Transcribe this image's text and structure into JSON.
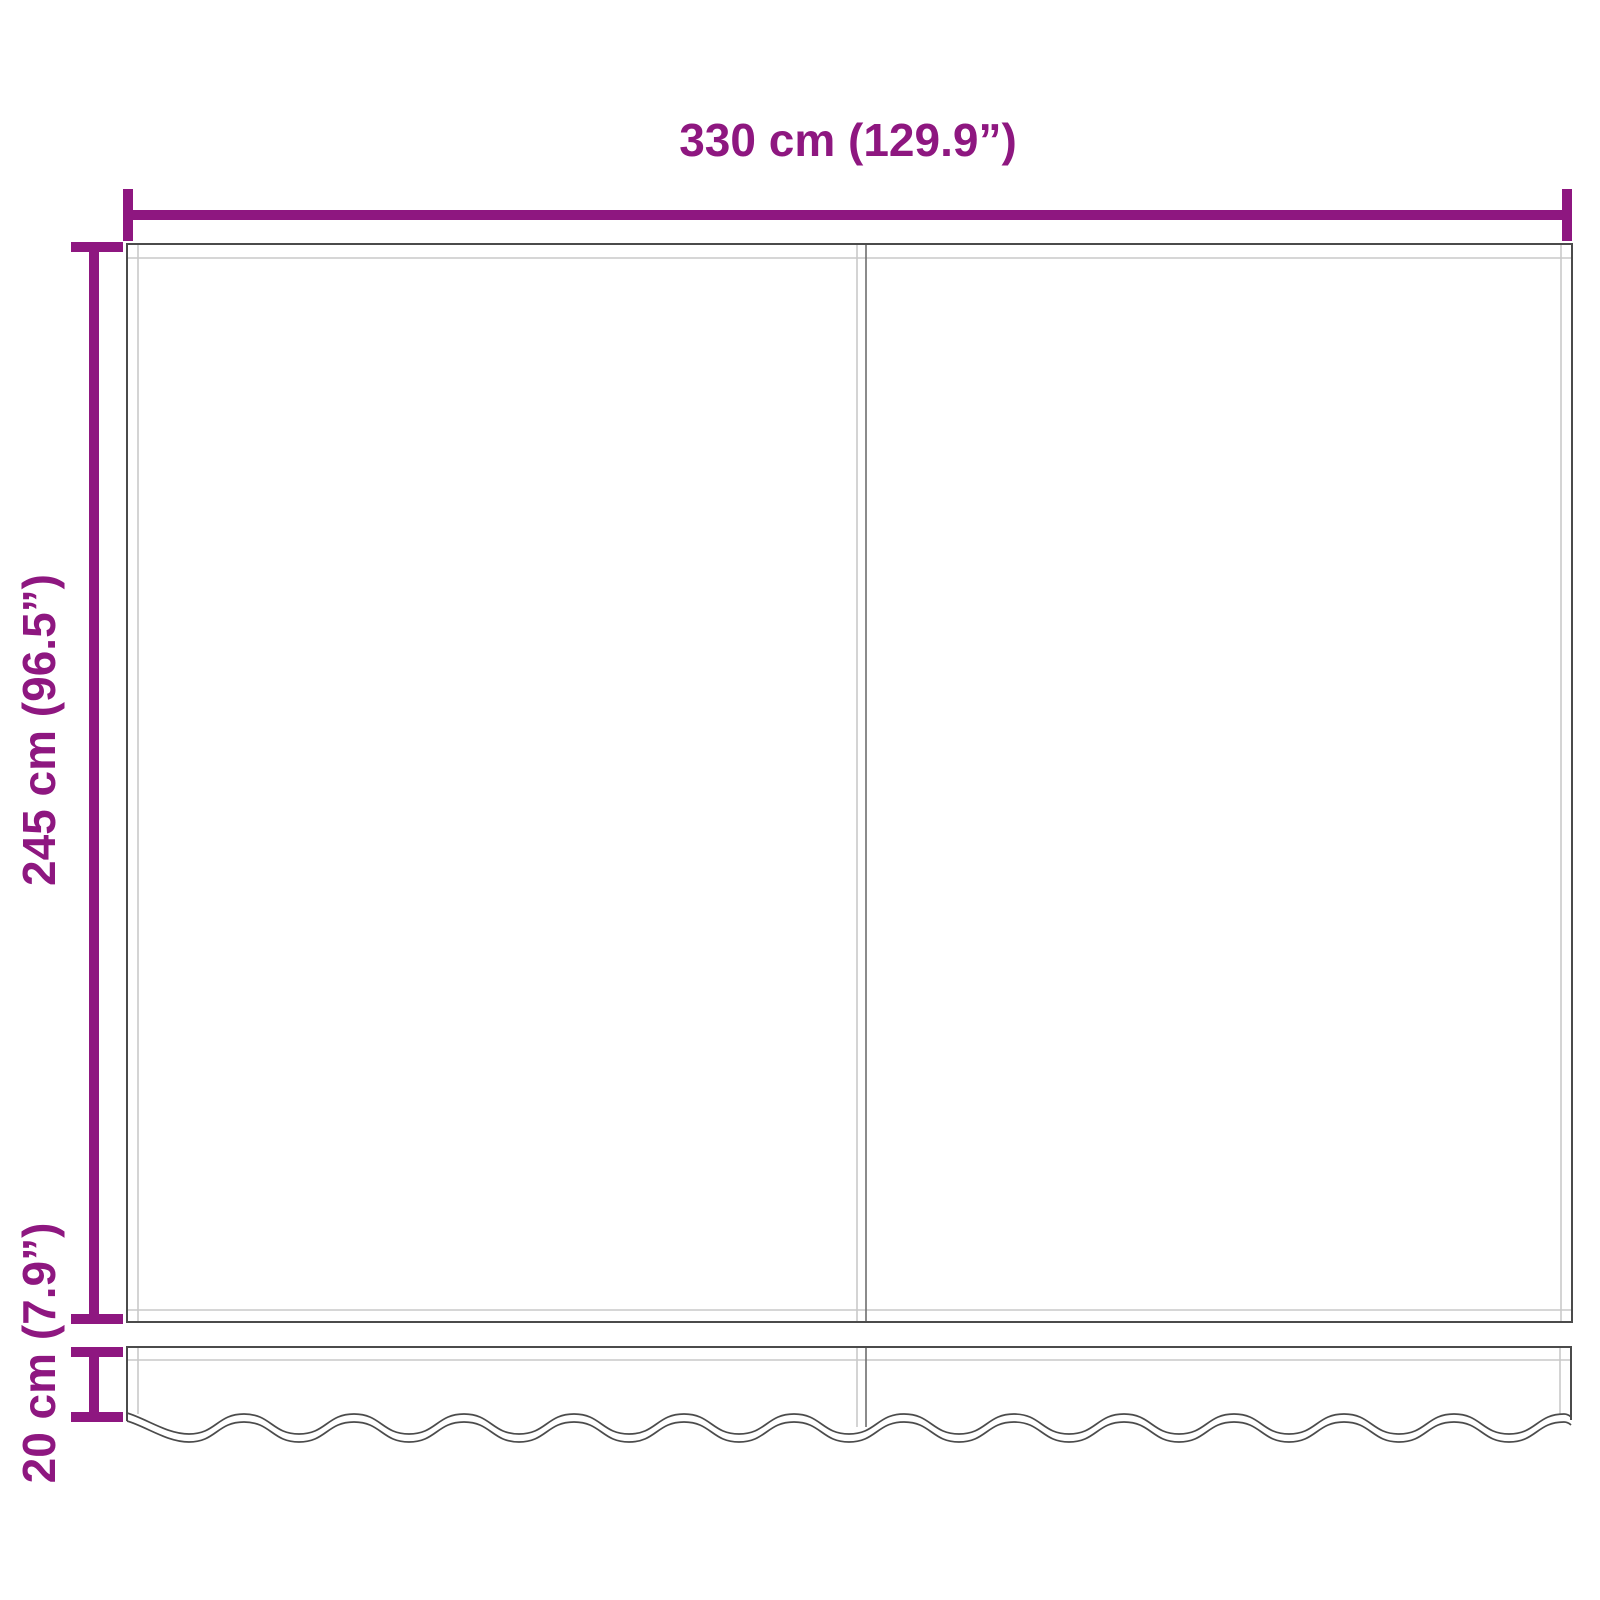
{
  "page": {
    "background": "#ffffff"
  },
  "colors": {
    "accent": "#8E1780",
    "fabric_outline": "#4b4b4b",
    "fabric_seam": "#c9c9c9",
    "center_seam": "#6e6e6e"
  },
  "labels": {
    "width": "330 cm (129.9”)",
    "height": "245 cm (96.5”)",
    "valance_height": "20 cm (7.9”)"
  }
}
